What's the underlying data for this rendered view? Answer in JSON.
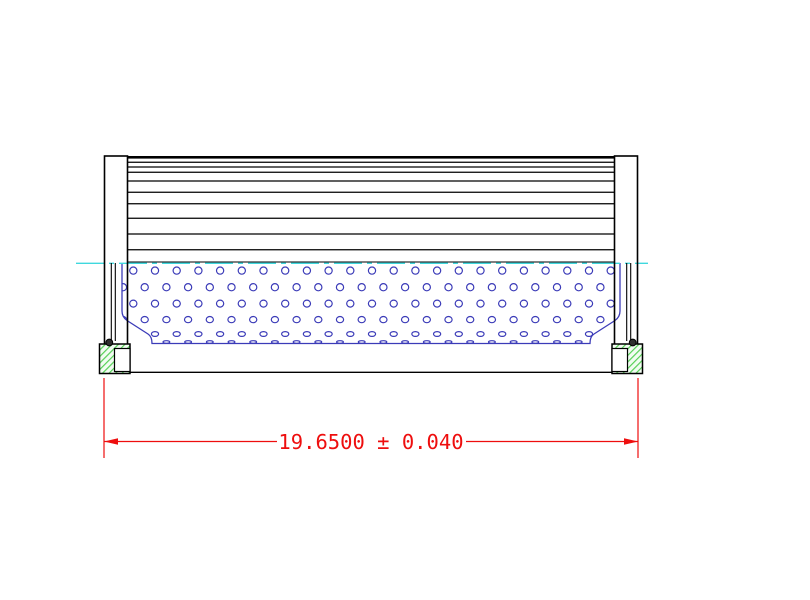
{
  "drawing": {
    "kind": "filter-element-cross-section",
    "dimension": {
      "label": "19.6500 ± 0.040",
      "value": "19.6500",
      "tolerance": "0.040"
    },
    "colors": {
      "line": "#000000",
      "perforation": "#3b3bb8",
      "centerline": "#3fd8de",
      "dimension": "#ee0e0e",
      "hatch": "#55d055",
      "oring": "#2f2f2f"
    },
    "geometry": {
      "centerline": {
        "y": 263.3,
        "x1": 76,
        "x2": 648,
        "dash": "28 5 5 5"
      },
      "pleats": {
        "x1": 127.5,
        "x2": 614.5,
        "top_y": 156,
        "top_thickness": 2.6,
        "line_ys": [
          162.3,
          167,
          172.3,
          181,
          192.3,
          203.7,
          218.3,
          234,
          249.7
        ],
        "bottom_y": 262
      },
      "core": {
        "outline": "M122,263 L122,311 Q122,317 127,320.5 L148,334 Q152,336.5 152,343.5 L590,343.5 Q590,336.5 594,334 L615,320.5 Q620,317 620,311 L620,263",
        "hole_rows": [
          {
            "y": 270.6,
            "rx": 3.6,
            "ry": 3.6,
            "x0": 133.3,
            "step": 21.7,
            "n": 23
          },
          {
            "y": 287.2,
            "rx": 3.6,
            "ry": 3.6,
            "x0": 123.0,
            "step": 21.7,
            "n": 23
          },
          {
            "y": 303.6,
            "rx": 3.6,
            "ry": 3.5,
            "x0": 133.3,
            "step": 21.7,
            "n": 23
          },
          {
            "y": 319.6,
            "rx": 3.6,
            "ry": 3.1,
            "x0": 123.0,
            "step": 21.7,
            "n": 23
          },
          {
            "y": 334.0,
            "rx": 3.6,
            "ry": 2.4,
            "x0": 133.3,
            "step": 21.7,
            "n": 23
          },
          {
            "y": 342.0,
            "rx": 3.4,
            "ry": 1.3,
            "x0": 123.0,
            "step": 21.7,
            "n": 23
          }
        ]
      },
      "seams": {
        "y1": 263,
        "y2": 341,
        "left": [
          111.3,
          115.3
        ],
        "right": [
          626.7,
          630.7
        ]
      }
    }
  }
}
